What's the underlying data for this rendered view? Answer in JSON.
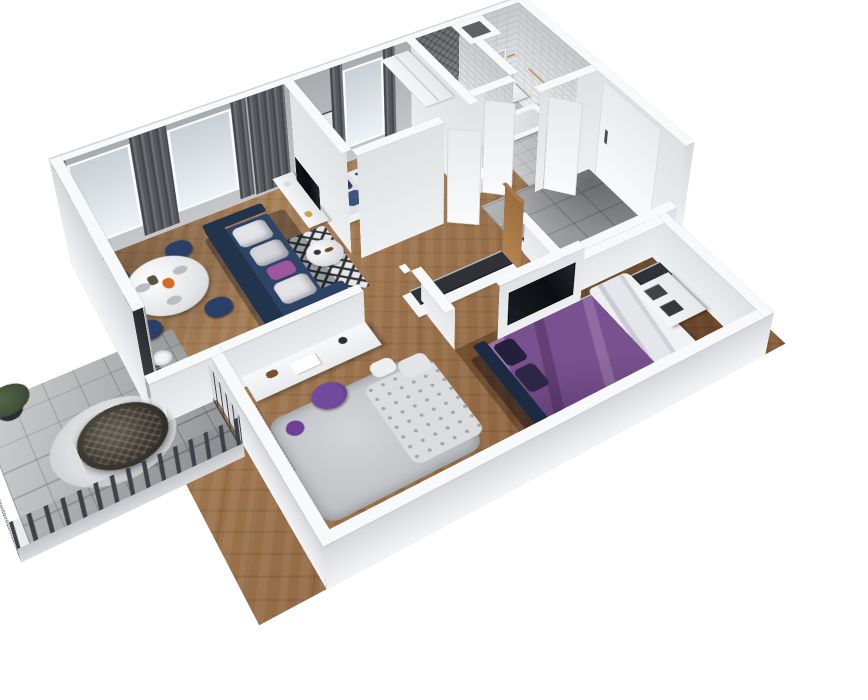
{
  "scene": {
    "type": "3d-floor-plan-render",
    "view": "isometric dollhouse cutaway, ceilings removed, near walls cut low",
    "background": "#ffffff"
  },
  "palette": {
    "wall_top": "#f8f9fa",
    "wall_outer": "#e8eaec",
    "wall_gray": "#b6b9bb",
    "wood": "#94683f",
    "wood_dark": "#6e4c30",
    "tile_gray": "#94979a",
    "tile_light": "#c6c9cb",
    "balcony": "#b3b5b7",
    "railing": "#3c4149",
    "sofa_navy": "#2d4363",
    "sofa_navy_dark": "#22334c",
    "cushion_white": "#e3e4e8",
    "pillow_purple": "#a0569c",
    "bed_purple": "#7a5190",
    "bed_purple_dark": "#5e3c72",
    "headboard_navy": "#1c2a42",
    "duvet_white": "#dee0e4",
    "kids_navy": "#2b3f66",
    "office_chair_purple": "#714a9e",
    "oak": "#aa784a",
    "gold": "#bd9254",
    "tv_black": "#101318",
    "clothes_dark": "#32363c",
    "hanger_wood": "#bd8950",
    "curtain_gray": "#55585c",
    "glass": "#dde2e6",
    "rug_light": "#cbced0",
    "plant_green": "#41503a",
    "door_white": "#f7f8f9"
  },
  "rooms": [
    {
      "name": "living-room",
      "floor": "herringbone-wood",
      "furniture": [
        "corner-sofa-navy",
        "white-cushions",
        "purple-accent-pillow",
        "round-dining-table",
        "dining-chairs-navy-x4",
        "tableware-and-orange-pitcher",
        "tv-sideboard-white",
        "television",
        "round-coffee-table",
        "bw-diamond-rug",
        "floor-lamp",
        "butterfly-wall-art",
        "two-windows-with-gray-curtains",
        "balcony-door",
        "radiator"
      ]
    },
    {
      "name": "kids-bedroom",
      "floor": "herringbone-wood",
      "furniture": [
        "single-bed-white-frame",
        "navy-pillows",
        "patterned-blanket",
        "tall-white-wardrobe",
        "two-wall-art-frames",
        "window-with-curtains"
      ]
    },
    {
      "name": "wc",
      "floor": "gray-tile",
      "furniture": [
        "toilet",
        "dark-chevron-tile-walls",
        "brass-accessories"
      ]
    },
    {
      "name": "bathroom",
      "floor": "light-tile",
      "furniture": [
        "bathtub",
        "vanity-with-sink",
        "brass-fixtures",
        "white-brick-tile-walls",
        "duct-shaft",
        "open-door"
      ]
    },
    {
      "name": "entry-hall",
      "floor": "gray-tile",
      "furniture": [
        "entrance-door-white",
        "long-open-coat-rack-with-hangers",
        "side-coat-rack"
      ]
    },
    {
      "name": "corridor-dressing",
      "floor": "herringbone-wood",
      "furniture": [
        "open-closet-with-hangers",
        "oak-side-panel"
      ]
    },
    {
      "name": "study",
      "floor": "herringbone-wood",
      "furniture": [
        "white-desk",
        "desk-lamp",
        "papers",
        "figurine",
        "purple-swivel-chair",
        "purple-basket",
        "shag-rug",
        "daybed-with-pillows",
        "window-with-radiator"
      ]
    },
    {
      "name": "master-bedroom",
      "floor": "dark-herringbone-wood",
      "furniture": [
        "double-bed-purple-bedding",
        "navy-headboard",
        "white-duvet",
        "wall-mounted-tv",
        "open-wardrobe-with-hangers",
        "shelf-unit-with-boxes",
        "beige-ottoman",
        "window-with-radiator"
      ]
    },
    {
      "name": "balcony",
      "floor": "concrete-tile",
      "furniture": [
        "metal-railing",
        "hanging-egg-chair",
        "round-rug",
        "potted-plant"
      ]
    }
  ]
}
